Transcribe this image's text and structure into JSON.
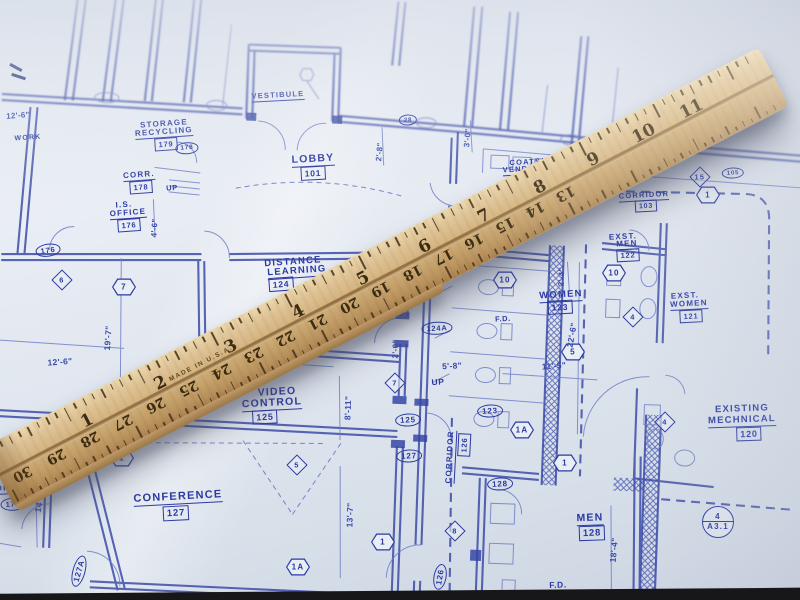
{
  "colors": {
    "ink": "#2b3aa3",
    "paper": "#e9eef5",
    "ruler_wood": "#d4b480",
    "ruler_marks": "#46331a"
  },
  "plan": {
    "labels": [
      {
        "k": "rl",
        "t": "STORAGE",
        "x": 164,
        "y": 124,
        "r": -4,
        "fs": 8
      },
      {
        "k": "rm",
        "t": "RECYCLING",
        "x": 164,
        "y": 133,
        "r": -4,
        "fs": 8
      },
      {
        "k": "nb",
        "t": "179",
        "x": 166,
        "y": 144,
        "r": -4,
        "fs": 7.5
      },
      {
        "k": "no",
        "t": "178",
        "x": 187,
        "y": 148,
        "r": -4,
        "fs": 6.5
      },
      {
        "k": "rm",
        "t": "CORR.",
        "x": 139,
        "y": 176,
        "r": -4,
        "fs": 8
      },
      {
        "k": "nb",
        "t": "178",
        "x": 141,
        "y": 187,
        "r": -4,
        "fs": 7.5
      },
      {
        "k": "tx",
        "t": "UP",
        "x": 172,
        "y": 188,
        "r": -4,
        "fs": 7.5
      },
      {
        "k": "rm",
        "t": "LOBBY",
        "x": 313,
        "y": 160,
        "r": -3,
        "fs": 10.5
      },
      {
        "k": "nb",
        "t": "101",
        "x": 313,
        "y": 173,
        "r": -3,
        "fs": 8.5
      },
      {
        "k": "rm",
        "t": "VESTIBULE",
        "x": 278,
        "y": 96,
        "r": -3,
        "fs": 7.5
      },
      {
        "k": "rl",
        "t": "I.S.",
        "x": 124,
        "y": 205,
        "r": -4,
        "fs": 8
      },
      {
        "k": "rm",
        "t": "OFFICE",
        "x": 128,
        "y": 214,
        "r": -4,
        "fs": 8
      },
      {
        "k": "nb",
        "t": "176",
        "x": 129,
        "y": 225,
        "r": -4,
        "fs": 7.5
      },
      {
        "k": "no",
        "t": "176",
        "x": 48,
        "y": 250,
        "r": -8,
        "fs": 7.5
      },
      {
        "k": "rl",
        "t": "WORK",
        "x": 28,
        "y": 138,
        "r": -4,
        "fs": 7
      },
      {
        "k": "rl",
        "t": "DISTANCE",
        "x": 293,
        "y": 262,
        "r": -4,
        "fs": 9.5
      },
      {
        "k": "rm",
        "t": "LEARNING",
        "x": 297,
        "y": 272,
        "r": -4,
        "fs": 9.5
      },
      {
        "k": "nb",
        "t": "124",
        "x": 281,
        "y": 284,
        "r": -4,
        "fs": 8.5
      },
      {
        "k": "rl",
        "t": "VIDEO",
        "x": 277,
        "y": 392,
        "r": -3,
        "fs": 10.5
      },
      {
        "k": "rm",
        "t": "CONTROL",
        "x": 272,
        "y": 404,
        "r": -3,
        "fs": 10.5
      },
      {
        "k": "nb",
        "t": "125",
        "x": 265,
        "y": 417,
        "r": -3,
        "fs": 9
      },
      {
        "k": "rm",
        "t": "CONFERENCE",
        "x": 178,
        "y": 498,
        "r": -3,
        "fs": 11
      },
      {
        "k": "nb",
        "t": "127",
        "x": 176,
        "y": 513,
        "r": -3,
        "fs": 9.5
      },
      {
        "k": "rm",
        "t": "WOMEN",
        "x": 561,
        "y": 296,
        "r": -3,
        "fs": 9.5
      },
      {
        "k": "nb",
        "t": "123",
        "x": 560,
        "y": 307,
        "r": -3,
        "fs": 8.5
      },
      {
        "k": "rm",
        "t": "MEN",
        "x": 590,
        "y": 519,
        "r": -2,
        "fs": 10.5
      },
      {
        "k": "nb",
        "t": "128",
        "x": 592,
        "y": 533,
        "r": -2,
        "fs": 9.5
      },
      {
        "k": "rm",
        "t": "CORRIDOR",
        "x": 451,
        "y": 457,
        "r": -87,
        "fs": 8
      },
      {
        "k": "nb",
        "t": "126",
        "x": 464,
        "y": 445,
        "r": -87,
        "fs": 7.5
      },
      {
        "k": "rl",
        "t": "EXST.",
        "x": 623,
        "y": 237,
        "r": -3,
        "fs": 8
      },
      {
        "k": "rm",
        "t": "MEN",
        "x": 627,
        "y": 245,
        "r": -3,
        "fs": 8
      },
      {
        "k": "nb",
        "t": "122",
        "x": 628,
        "y": 255,
        "r": -3,
        "fs": 7.5
      },
      {
        "k": "rl",
        "t": "EXST.",
        "x": 685,
        "y": 296,
        "r": -3,
        "fs": 8
      },
      {
        "k": "rm",
        "t": "WOMEN",
        "x": 689,
        "y": 305,
        "r": -3,
        "fs": 8
      },
      {
        "k": "nb",
        "t": "121",
        "x": 691,
        "y": 316,
        "r": -3,
        "fs": 7.5
      },
      {
        "k": "rm",
        "t": "CORRIDOR",
        "x": 644,
        "y": 196,
        "r": -3,
        "fs": 7.5
      },
      {
        "k": "nb",
        "t": "103",
        "x": 646,
        "y": 206,
        "r": -3,
        "fs": 7
      },
      {
        "k": "rl",
        "t": "COATS/",
        "x": 527,
        "y": 162,
        "r": -3,
        "fs": 7.5
      },
      {
        "k": "rm",
        "t": "VENDING",
        "x": 524,
        "y": 170,
        "r": -3,
        "fs": 7.5
      },
      {
        "k": "rl",
        "t": "EXISTING",
        "x": 742,
        "y": 409,
        "r": -2,
        "fs": 9.5
      },
      {
        "k": "rm",
        "t": "MECHNICAL",
        "x": 742,
        "y": 421,
        "r": -2,
        "fs": 9.5
      },
      {
        "k": "nb",
        "t": "120",
        "x": 749,
        "y": 434,
        "r": -2,
        "fs": 9
      },
      {
        "k": "rl",
        "t": "I.S.",
        "x": 10,
        "y": 477,
        "r": -3,
        "fs": 8
      },
      {
        "k": "rm",
        "t": "OFFICE",
        "x": 14,
        "y": 489,
        "r": -3,
        "fs": 8
      },
      {
        "k": "no",
        "t": "175",
        "x": 13,
        "y": 504,
        "r": -3,
        "fs": 7.5
      },
      {
        "k": "no",
        "t": "124A",
        "x": 437,
        "y": 328,
        "r": -3,
        "fs": 7.5
      },
      {
        "k": "no",
        "t": "125",
        "x": 408,
        "y": 420,
        "r": -3,
        "fs": 8
      },
      {
        "k": "no",
        "t": "127",
        "x": 409,
        "y": 456,
        "r": -3,
        "fs": 8
      },
      {
        "k": "no",
        "t": "123",
        "x": 490,
        "y": 411,
        "r": -3,
        "fs": 8
      },
      {
        "k": "no",
        "t": "128",
        "x": 500,
        "y": 484,
        "r": -3,
        "fs": 8
      },
      {
        "k": "no",
        "t": "127A",
        "x": 79,
        "y": 571,
        "r": -75,
        "fs": 8
      },
      {
        "k": "no",
        "t": "126",
        "x": 440,
        "y": 577,
        "r": -80,
        "fs": 8
      },
      {
        "k": "no",
        "t": "105",
        "x": 733,
        "y": 173,
        "r": -3,
        "fs": 6
      },
      {
        "k": "no",
        "t": "28",
        "x": 408,
        "y": 120,
        "r": -3,
        "fs": 6
      },
      {
        "k": "hx",
        "t": "7",
        "x": 124,
        "y": 287
      },
      {
        "k": "hx",
        "t": "1",
        "x": 122,
        "y": 458
      },
      {
        "k": "hx",
        "t": "1A",
        "x": 298,
        "y": 567
      },
      {
        "k": "hx",
        "t": "1",
        "x": 383,
        "y": 542
      },
      {
        "k": "hx",
        "t": "1",
        "x": 565,
        "y": 463
      },
      {
        "k": "hx",
        "t": "1A",
        "x": 522,
        "y": 430
      },
      {
        "k": "hx",
        "t": "10",
        "x": 505,
        "y": 280
      },
      {
        "k": "hx",
        "t": "10",
        "x": 614,
        "y": 273
      },
      {
        "k": "hx",
        "t": "5",
        "x": 573,
        "y": 352
      },
      {
        "k": "hx",
        "t": "1",
        "x": 708,
        "y": 195
      },
      {
        "k": "di",
        "t": "7",
        "x": 395,
        "y": 383
      },
      {
        "k": "di",
        "t": "5",
        "x": 297,
        "y": 465
      },
      {
        "k": "di",
        "t": "6",
        "x": 62,
        "y": 280
      },
      {
        "k": "di",
        "t": "4",
        "x": 633,
        "y": 317
      },
      {
        "k": "di",
        "t": "4",
        "x": 665,
        "y": 422
      },
      {
        "k": "di",
        "t": "8",
        "x": 455,
        "y": 531
      },
      {
        "k": "di",
        "t": "15",
        "x": 700,
        "y": 177
      },
      {
        "k": "sc",
        "t": "4",
        "b": "A3.1",
        "x": 718,
        "y": 522
      },
      {
        "k": "dm",
        "t": "12'-6\"",
        "x": 60,
        "y": 362,
        "r": -4,
        "fs": 8.5
      },
      {
        "k": "dm",
        "t": "19'-7\"",
        "x": 108,
        "y": 338,
        "r": -86,
        "fs": 8.5
      },
      {
        "k": "dm",
        "t": "14'-6\"",
        "x": 40,
        "y": 500,
        "r": -80,
        "fs": 8.5
      },
      {
        "k": "dm",
        "t": "4'-6\"",
        "x": 155,
        "y": 228,
        "r": -86,
        "fs": 8
      },
      {
        "k": "dm",
        "t": "9'-4\"",
        "x": 278,
        "y": 364,
        "r": -3,
        "fs": 8.5
      },
      {
        "k": "dm",
        "t": "8'-11\"",
        "x": 348,
        "y": 408,
        "r": -88,
        "fs": 8.5
      },
      {
        "k": "dm",
        "t": "2'-0\"",
        "x": 396,
        "y": 349,
        "r": -88,
        "fs": 8
      },
      {
        "k": "dm",
        "t": "13'-7\"",
        "x": 350,
        "y": 515,
        "r": -88,
        "fs": 8.5
      },
      {
        "k": "dm",
        "t": "5'-8\"",
        "x": 452,
        "y": 366,
        "r": -3,
        "fs": 8.5
      },
      {
        "k": "dm",
        "t": "11'-5\"",
        "x": 554,
        "y": 366,
        "r": -4,
        "fs": 8.5
      },
      {
        "k": "dm",
        "t": "22'-6\"",
        "x": 572,
        "y": 335,
        "r": -80,
        "fs": 8.5
      },
      {
        "k": "dm",
        "t": "2'-4\"",
        "x": 562,
        "y": 277,
        "r": -88,
        "fs": 8
      },
      {
        "k": "dm",
        "t": "18'-4\"",
        "x": 614,
        "y": 550,
        "r": -85,
        "fs": 8.5
      },
      {
        "k": "dm",
        "t": "2'-8\"",
        "x": 380,
        "y": 152,
        "r": -85,
        "fs": 8
      },
      {
        "k": "dm",
        "t": "3'-0\"",
        "x": 468,
        "y": 138,
        "r": -85,
        "fs": 8
      },
      {
        "k": "dm",
        "t": "12'-6\"",
        "x": 18,
        "y": 116,
        "r": -4,
        "fs": 8
      },
      {
        "k": "tx",
        "t": "UP",
        "x": 438,
        "y": 382,
        "r": -3,
        "fs": 8.5
      },
      {
        "k": "tx",
        "t": "F.D.",
        "x": 503,
        "y": 319,
        "r": -3,
        "fs": 7.5
      },
      {
        "k": "tx",
        "t": "F.D.",
        "x": 558,
        "y": 585,
        "r": -2,
        "fs": 8.5
      }
    ]
  },
  "ruler": {
    "made_in": "MADE IN U.S.A.",
    "top_numbers": [
      "1",
      "2",
      "3",
      "4",
      "5",
      "6",
      "7",
      "8",
      "9",
      "10",
      "11"
    ],
    "bottom_numbers": [
      "30",
      "29",
      "28",
      "27",
      "26",
      "25",
      "24",
      "23",
      "22",
      "21",
      "20",
      "19",
      "18",
      "17",
      "16",
      "15",
      "14",
      "13"
    ]
  }
}
